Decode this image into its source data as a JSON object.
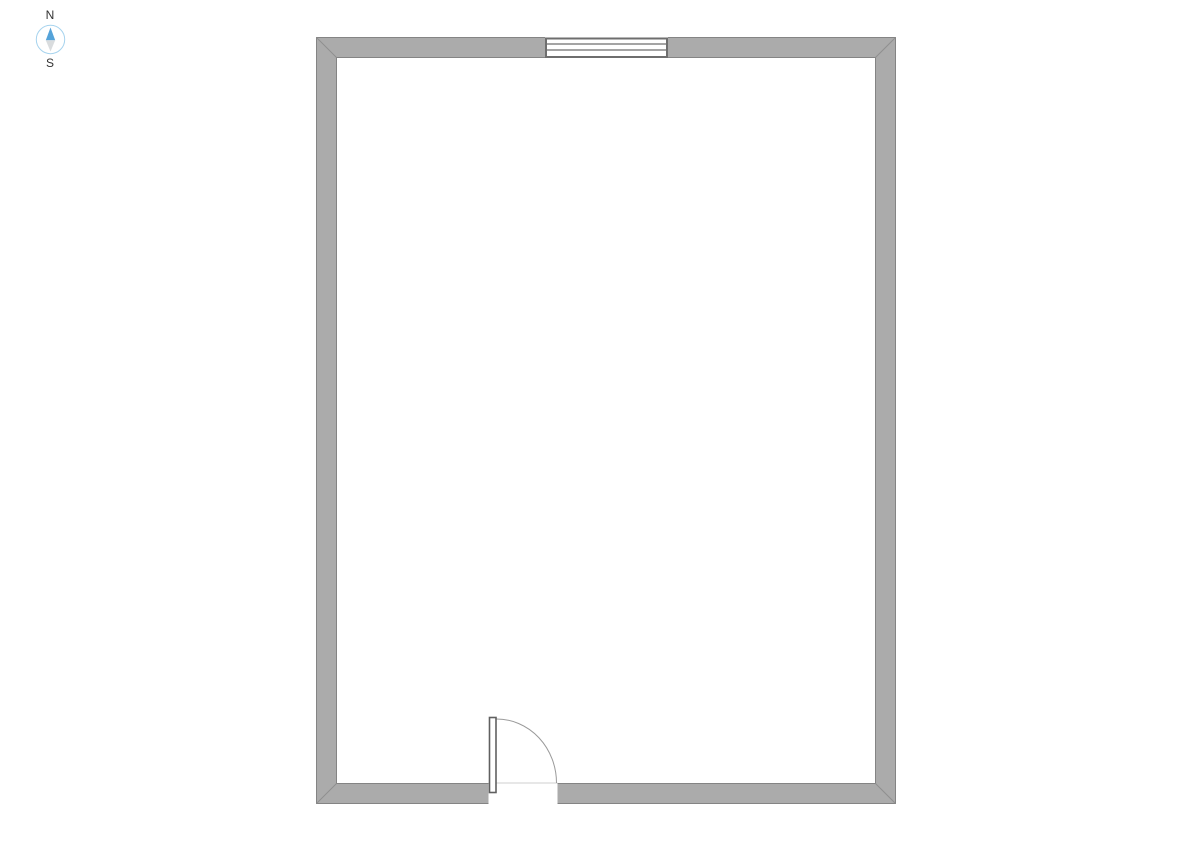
{
  "compass": {
    "north_label": "N",
    "south_label": "S"
  },
  "colors": {
    "background": "#ffffff",
    "wall_fill": "#ababab",
    "wall_outline": "#848484",
    "corner_miter": "#8f8f8f",
    "window_frame": "#6e6e6e",
    "window_fill": "#ffffff",
    "door_stroke": "#606060",
    "door_arc": "#9a9a9a",
    "threshold": "#cfcfcf",
    "compass_ring": "#a6d3ee",
    "compass_north": "#55a3d9",
    "compass_south": "#d9dcde",
    "compass_text": "#333333"
  }
}
